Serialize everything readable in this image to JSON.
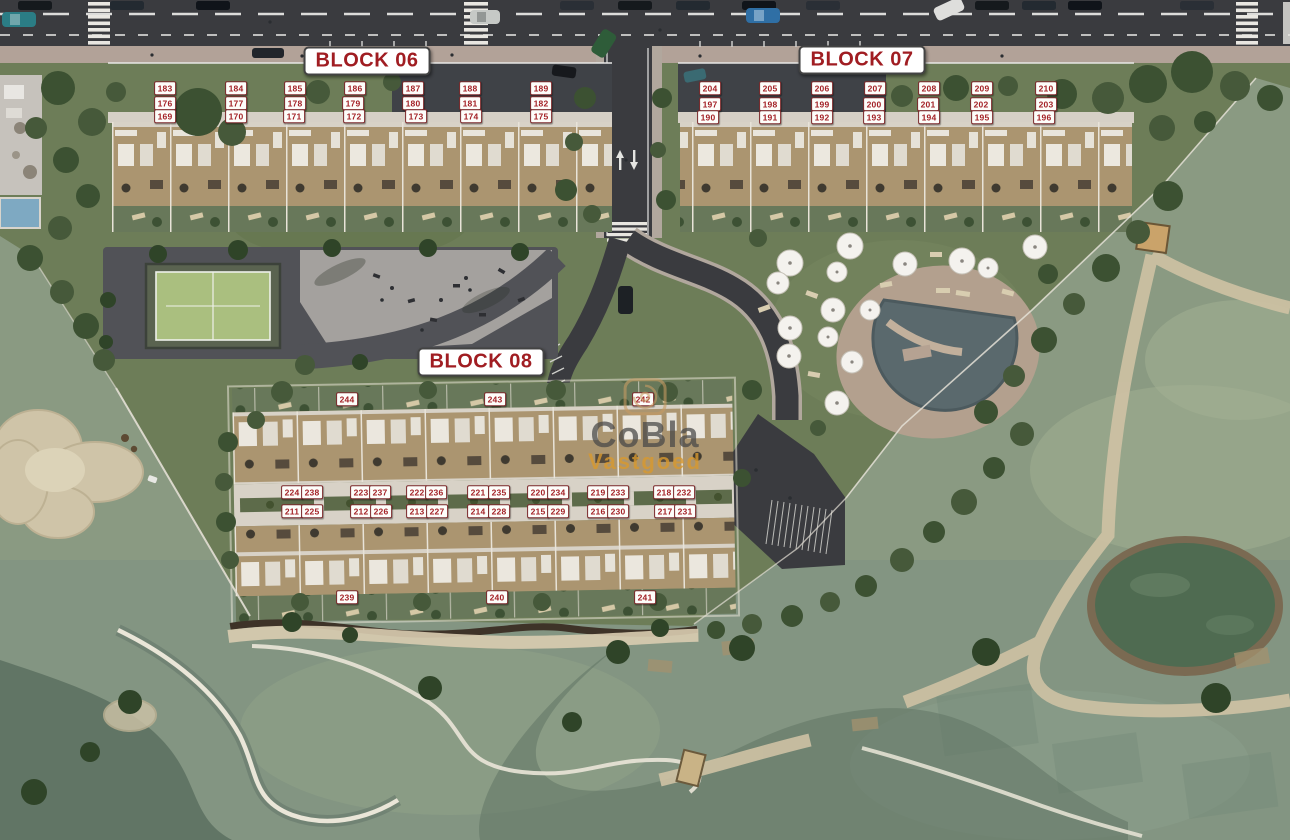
{
  "watermark": {
    "brand": "CoBla",
    "subtitle": "Vastgoed"
  },
  "colors": {
    "label_text": "#a32126",
    "label_bg": "#fdfdfa",
    "label_border": "#7d2a2c",
    "title_text": "#a01d22",
    "title_border": "#434343",
    "watermark_gray": "#474747",
    "watermark_orange": "#d9992f",
    "road": "#3a3b3f",
    "sidewalk": "#b2a298",
    "resort_green": "#6d7d58",
    "golf_green": "#8a9a82",
    "building_tan": "#ab9570",
    "pool_water": "#5a696d",
    "pond_green": "#4f6b51",
    "sand": "#cfc4a8",
    "court_green": "#aabf7f"
  },
  "blocks": [
    {
      "id": "block-06",
      "title": "BLOCK 06",
      "title_x": 367,
      "title_y": 61,
      "units": [
        {
          "n": "183",
          "x": 165,
          "y": 88
        },
        {
          "n": "184",
          "x": 236,
          "y": 88
        },
        {
          "n": "185",
          "x": 295,
          "y": 88
        },
        {
          "n": "186",
          "x": 355,
          "y": 88
        },
        {
          "n": "187",
          "x": 413,
          "y": 88
        },
        {
          "n": "188",
          "x": 470,
          "y": 88
        },
        {
          "n": "189",
          "x": 541,
          "y": 88
        },
        {
          "n": "176",
          "x": 165,
          "y": 103
        },
        {
          "n": "177",
          "x": 236,
          "y": 103
        },
        {
          "n": "178",
          "x": 295,
          "y": 103
        },
        {
          "n": "179",
          "x": 353,
          "y": 103
        },
        {
          "n": "180",
          "x": 413,
          "y": 103
        },
        {
          "n": "181",
          "x": 470,
          "y": 103
        },
        {
          "n": "182",
          "x": 541,
          "y": 103
        },
        {
          "n": "169",
          "x": 165,
          "y": 116
        },
        {
          "n": "170",
          "x": 236,
          "y": 116
        },
        {
          "n": "171",
          "x": 294,
          "y": 116
        },
        {
          "n": "172",
          "x": 354,
          "y": 116
        },
        {
          "n": "173",
          "x": 416,
          "y": 116
        },
        {
          "n": "174",
          "x": 471,
          "y": 116
        },
        {
          "n": "175",
          "x": 541,
          "y": 116
        }
      ]
    },
    {
      "id": "block-07",
      "title": "BLOCK 07",
      "title_x": 862,
      "title_y": 60,
      "units": [
        {
          "n": "204",
          "x": 710,
          "y": 88
        },
        {
          "n": "205",
          "x": 770,
          "y": 88
        },
        {
          "n": "206",
          "x": 822,
          "y": 88
        },
        {
          "n": "207",
          "x": 875,
          "y": 88
        },
        {
          "n": "208",
          "x": 929,
          "y": 88
        },
        {
          "n": "209",
          "x": 982,
          "y": 88
        },
        {
          "n": "210",
          "x": 1046,
          "y": 88
        },
        {
          "n": "197",
          "x": 710,
          "y": 104
        },
        {
          "n": "198",
          "x": 770,
          "y": 104
        },
        {
          "n": "199",
          "x": 822,
          "y": 104
        },
        {
          "n": "200",
          "x": 874,
          "y": 104
        },
        {
          "n": "201",
          "x": 928,
          "y": 104
        },
        {
          "n": "202",
          "x": 981,
          "y": 104
        },
        {
          "n": "203",
          "x": 1046,
          "y": 104
        },
        {
          "n": "190",
          "x": 708,
          "y": 117
        },
        {
          "n": "191",
          "x": 770,
          "y": 117
        },
        {
          "n": "192",
          "x": 822,
          "y": 117
        },
        {
          "n": "193",
          "x": 874,
          "y": 117
        },
        {
          "n": "194",
          "x": 929,
          "y": 117
        },
        {
          "n": "195",
          "x": 982,
          "y": 117
        },
        {
          "n": "196",
          "x": 1044,
          "y": 117
        }
      ]
    },
    {
      "id": "block-08",
      "title": "BLOCK 08",
      "title_x": 481,
      "title_y": 362,
      "units": [
        {
          "n": "244",
          "x": 347,
          "y": 399
        },
        {
          "n": "243",
          "x": 495,
          "y": 399
        },
        {
          "n": "242",
          "x": 643,
          "y": 399
        },
        {
          "n": "224",
          "x": 292,
          "y": 492
        },
        {
          "n": "238",
          "x": 312,
          "y": 492
        },
        {
          "n": "223",
          "x": 361,
          "y": 492
        },
        {
          "n": "237",
          "x": 380,
          "y": 492
        },
        {
          "n": "222",
          "x": 417,
          "y": 492
        },
        {
          "n": "236",
          "x": 436,
          "y": 492
        },
        {
          "n": "221",
          "x": 478,
          "y": 492
        },
        {
          "n": "235",
          "x": 499,
          "y": 492
        },
        {
          "n": "220",
          "x": 538,
          "y": 492
        },
        {
          "n": "234",
          "x": 558,
          "y": 492
        },
        {
          "n": "219",
          "x": 598,
          "y": 492
        },
        {
          "n": "233",
          "x": 618,
          "y": 492
        },
        {
          "n": "218",
          "x": 664,
          "y": 492
        },
        {
          "n": "232",
          "x": 684,
          "y": 492
        },
        {
          "n": "211",
          "x": 292,
          "y": 511
        },
        {
          "n": "225",
          "x": 312,
          "y": 511
        },
        {
          "n": "212",
          "x": 361,
          "y": 511
        },
        {
          "n": "226",
          "x": 381,
          "y": 511
        },
        {
          "n": "213",
          "x": 417,
          "y": 511
        },
        {
          "n": "227",
          "x": 437,
          "y": 511
        },
        {
          "n": "214",
          "x": 478,
          "y": 511
        },
        {
          "n": "228",
          "x": 499,
          "y": 511
        },
        {
          "n": "215",
          "x": 538,
          "y": 511
        },
        {
          "n": "229",
          "x": 558,
          "y": 511
        },
        {
          "n": "216",
          "x": 598,
          "y": 511
        },
        {
          "n": "230",
          "x": 618,
          "y": 511
        },
        {
          "n": "217",
          "x": 665,
          "y": 511
        },
        {
          "n": "231",
          "x": 685,
          "y": 511
        },
        {
          "n": "239",
          "x": 347,
          "y": 597
        },
        {
          "n": "240",
          "x": 497,
          "y": 597
        },
        {
          "n": "241",
          "x": 645,
          "y": 597
        }
      ]
    }
  ]
}
